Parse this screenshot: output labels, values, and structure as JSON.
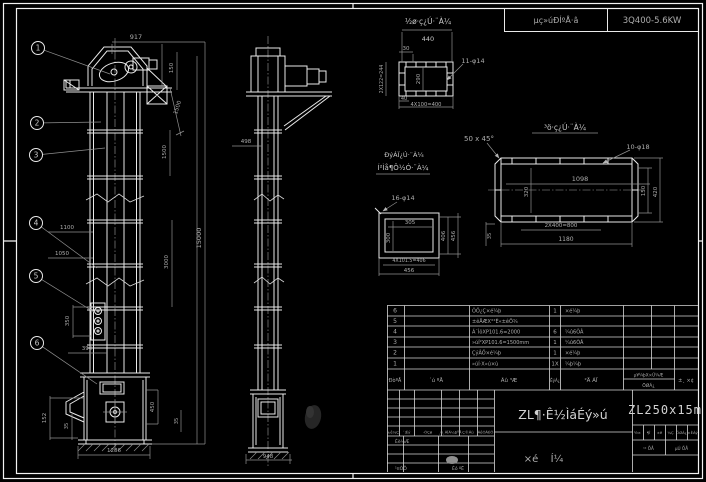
{
  "colors": {
    "background": "#000000",
    "line": "#e9e9e9",
    "dim": "#8f8f8f",
    "text": "#b2b2b2"
  },
  "header_strip": {
    "left": "µç»úÐÍºÅ·â",
    "right": "3Q400-5.6KW"
  },
  "balloons": [
    {
      "t": "1",
      "cx": 38,
      "cy": 48,
      "lx": 110,
      "ly": 74
    },
    {
      "t": "2",
      "cx": 37,
      "cy": 123,
      "lx": 101,
      "ly": 122
    },
    {
      "t": "3",
      "cx": 36,
      "cy": 155,
      "lx": 105,
      "ly": 148
    },
    {
      "t": "4",
      "cx": 36,
      "cy": 223,
      "lx": 97,
      "ly": 268
    },
    {
      "t": "5",
      "cx": 36,
      "cy": 276,
      "lx": 94,
      "ly": 312
    },
    {
      "t": "6",
      "cx": 37,
      "cy": 343,
      "lx": 97,
      "ly": 384
    }
  ],
  "annotations": [
    {
      "t": "917",
      "x": 136,
      "y": 39,
      "s": 6.5
    },
    {
      "t": "150",
      "x": 173,
      "y": 68,
      "r": -90,
      "s": 5.5
    },
    {
      "t": "1500",
      "x": 179,
      "y": 108,
      "r": -72,
      "s": 5.5
    },
    {
      "t": "1500",
      "x": 166,
      "y": 152,
      "r": -90,
      "s": 5.5
    },
    {
      "t": "3000",
      "x": 168,
      "y": 262,
      "r": -90,
      "s": 5.5
    },
    {
      "t": "15000",
      "x": 201,
      "y": 238,
      "r": -90,
      "s": 6.5
    },
    {
      "t": "1100",
      "x": 67,
      "y": 229,
      "s": 5.5
    },
    {
      "t": "1050",
      "x": 62,
      "y": 255,
      "s": 5.5
    },
    {
      "t": "350",
      "x": 69,
      "y": 321,
      "r": -90,
      "s": 5.5
    },
    {
      "t": "390",
      "x": 87,
      "y": 350,
      "s": 5.5
    },
    {
      "t": "152",
      "x": 46,
      "y": 418,
      "r": -90,
      "s": 5.5
    },
    {
      "t": "35",
      "x": 68,
      "y": 426,
      "r": -90,
      "s": 5
    },
    {
      "t": "1286",
      "x": 114,
      "y": 452,
      "s": 5.5
    },
    {
      "t": "450",
      "x": 154,
      "y": 407,
      "r": -90,
      "s": 5.5
    },
    {
      "t": "35",
      "x": 178,
      "y": 421,
      "r": -90,
      "s": 5
    },
    {
      "t": "498",
      "x": 246,
      "y": 143,
      "s": 5.5
    },
    {
      "t": "948",
      "x": 268,
      "y": 458,
      "s": 5.5
    },
    {
      "t": "½ø·ç¿Ú·¨À¼",
      "x": 428,
      "y": 24,
      "s": 7.5,
      "c": "lbl"
    },
    {
      "t": "440",
      "x": 428,
      "y": 41,
      "s": 6.5,
      "c": "lbl"
    },
    {
      "t": "30",
      "x": 406,
      "y": 50,
      "s": 5.5
    },
    {
      "t": "11-φ14",
      "x": 473,
      "y": 63,
      "s": 6.5
    },
    {
      "t": "2X122=244",
      "x": 383,
      "y": 79,
      "r": -90,
      "s": 4.8
    },
    {
      "t": "290",
      "x": 420,
      "y": 79,
      "r": -90,
      "s": 5.5
    },
    {
      "t": "40",
      "x": 404,
      "y": 100,
      "s": 5
    },
    {
      "t": "4X100=400",
      "x": 426,
      "y": 106,
      "s": 5.2
    },
    {
      "t": "50 x 45°",
      "x": 479,
      "y": 141,
      "s": 7
    },
    {
      "t": "³ö·ç¿Ú·¨À¼",
      "x": 565,
      "y": 130,
      "s": 7.5,
      "c": "lbl"
    },
    {
      "t": "10-φ18",
      "x": 638,
      "y": 149,
      "s": 6.5
    },
    {
      "t": "1098",
      "x": 580,
      "y": 181,
      "s": 6.5
    },
    {
      "t": "320",
      "x": 528,
      "y": 192,
      "r": -90,
      "s": 5.5
    },
    {
      "t": "2X400=800",
      "x": 561,
      "y": 227,
      "s": 5.5
    },
    {
      "t": "1180",
      "x": 566,
      "y": 241,
      "s": 6
    },
    {
      "t": "35",
      "x": 491,
      "y": 236,
      "r": -90,
      "s": 5
    },
    {
      "t": "150",
      "x": 645,
      "y": 191,
      "r": -90,
      "s": 5.5
    },
    {
      "t": "420",
      "x": 657,
      "y": 192,
      "r": -90,
      "s": 5.5
    },
    {
      "t": "ÐýÁÏ¿Ú·¨À¼",
      "x": 404,
      "y": 157,
      "s": 6.5,
      "c": "lbl"
    },
    {
      "t": "Í²Ìå¶Ô½Ó·¨À¼",
      "x": 403,
      "y": 170,
      "s": 7,
      "c": "lbl"
    },
    {
      "t": "16-φ14",
      "x": 403,
      "y": 200,
      "s": 6.5
    },
    {
      "t": "305",
      "x": 410,
      "y": 224,
      "s": 5.5
    },
    {
      "t": "300",
      "x": 390,
      "y": 238,
      "r": -90,
      "s": 5.5
    },
    {
      "t": "4X101.5=406",
      "x": 409,
      "y": 262,
      "s": 4.8
    },
    {
      "t": "456",
      "x": 409,
      "y": 272,
      "s": 5.5
    },
    {
      "t": "406",
      "x": 445,
      "y": 236,
      "r": -90,
      "s": 5.5
    },
    {
      "t": "456",
      "x": 455,
      "y": 236,
      "r": -90,
      "s": 5.5
    }
  ],
  "bom": {
    "col_headers": {
      "no": "ÐòºÅ",
      "code": "´ú ºÅ",
      "name": "Ãû ³Æ",
      "qty": "ÊýÁ¿",
      "mat": "²Ä ÁÏ",
      "weight_top": "µ¥¼þX×Ü¼Æ",
      "weight_bottom": "ÖØÁ¿",
      "note": "±¸ ×¢"
    },
    "rows": [
      {
        "no": "6",
        "code": "",
        "name": "ÕÖ¿Ç×é¼þ",
        "qty": "1",
        "mat": "×é¼þ"
      },
      {
        "no": "5",
        "code": "",
        "name": "±êÅÆX°²È«±êÖ¾",
        "qty": "",
        "mat": ""
      },
      {
        "no": "4",
        "code": "",
        "name": "Á´ÌõXP101.6=2000",
        "qty": "6",
        "mat": "¼û6ÕÂ"
      },
      {
        "no": "3",
        "code": "",
        "name": "»úÍ²XP101.6=1500mm",
        "qty": "1",
        "mat": "¼û6ÕÂ"
      },
      {
        "no": "2",
        "code": "",
        "name": "ÇýÂÖ×é¼þ",
        "qty": "1",
        "mat": "×é¼þ"
      },
      {
        "no": "1",
        "code": "",
        "name": "»úÍ·X»ú×ù",
        "qty": "1X",
        "mat": "¼þ¼þ"
      }
    ]
  },
  "titleblock": {
    "title": "ZL¶·Ê½ÌáÉý»ú",
    "subtitle_chars": [
      "×é",
      "Í¼"
    ],
    "model": "ZL250x15m",
    "rev_row": [
      "±ê¼Ç",
      "´¦Êý",
      "·ÖÇø",
      "¸ü¸ÄÎÄ¼þºÅ",
      "Ç©Ãû",
      "ÄêÔÂÈÕ"
    ],
    "sig_labels": [
      {
        "t": "Éè¼Æ",
        "x": 395,
        "y": 443
      },
      {
        "t": "¹¤ÒÕ",
        "x": 395,
        "y": 470
      },
      {
        "t": "Éó ºË",
        "x": 452,
        "y": 470
      }
    ],
    "right_row1": [
      "½×",
      "¶Î",
      "±ê",
      "¼Ç",
      "ÖØÁ¿",
      "±ÈÀý"
    ],
    "right_row2": [
      "¹² ÕÅ",
      "µÚ ÕÅ"
    ]
  }
}
